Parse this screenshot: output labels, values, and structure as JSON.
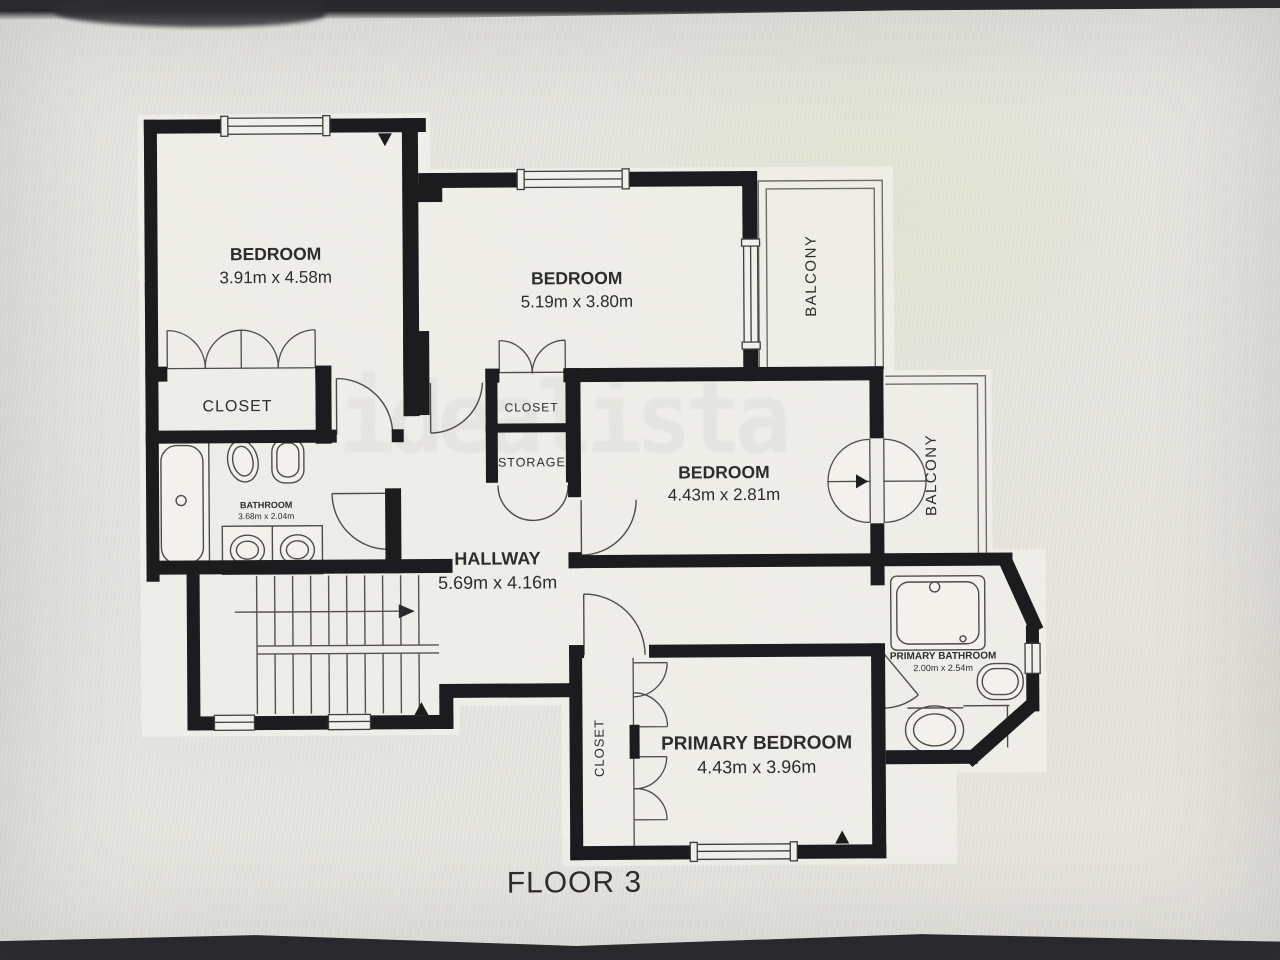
{
  "watermark": {
    "text": "idealista"
  },
  "floor": {
    "label": "FLOOR 3"
  },
  "rooms": {
    "bedroom_top_left": {
      "name": "BEDROOM",
      "dims": "3.91m x 4.58m"
    },
    "bedroom_top_center": {
      "name": "BEDROOM",
      "dims": "5.19m x 3.80m"
    },
    "bedroom_middle": {
      "name": "BEDROOM",
      "dims": "4.43m x 2.81m"
    },
    "primary_bedroom": {
      "name": "PRIMARY BEDROOM",
      "dims": "4.43m x 3.96m"
    },
    "hallway": {
      "name": "HALLWAY",
      "dims": "5.69m x 4.16m"
    },
    "bathroom": {
      "name": "BATHROOM",
      "dims": "3.68m x 2.04m"
    },
    "primary_bathroom": {
      "name": "PRIMARY BATHROOM",
      "dims": "2.00m x 2.54m"
    },
    "closet_left": {
      "name": "CLOSET"
    },
    "closet_center": {
      "name": "CLOSET"
    },
    "storage": {
      "name": "STORAGE"
    },
    "closet_primary": {
      "name": "CLOSET"
    },
    "balcony_top": {
      "name": "BALCONY"
    },
    "balcony_right": {
      "name": "BALCONY"
    }
  },
  "colors": {
    "wall": "#1c1b1d",
    "thin_line": "#4e4c48",
    "paper": "#f0efea",
    "label": "#2e2d2b",
    "watermark": "#7c7c7a",
    "photo_edge": "#29282b"
  }
}
